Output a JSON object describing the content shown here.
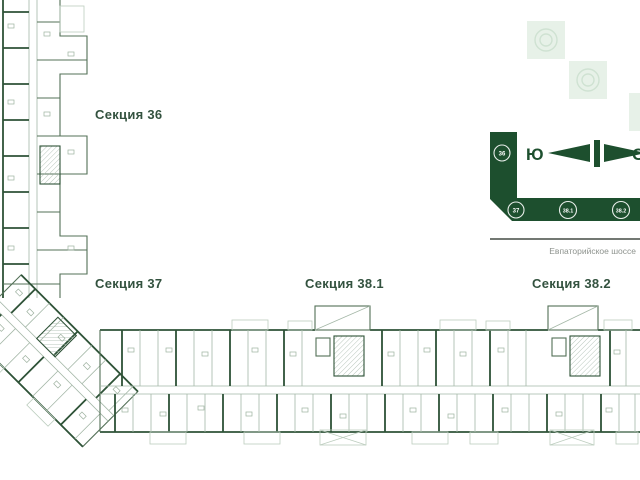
{
  "labels": {
    "section36": "Секция 36",
    "section37": "Секция 37",
    "section381": "Секция 38.1",
    "section382": "Секция 38.2"
  },
  "minimap": {
    "markers": [
      {
        "label": "36"
      },
      {
        "label": "37"
      },
      {
        "label": "38.1"
      },
      {
        "label": "38.2"
      }
    ],
    "compass": {
      "south_label": "Ю",
      "north_label": "С"
    },
    "road_label": "Евпаторийское шоссе"
  },
  "colors": {
    "brand_green": "#1d4f2e",
    "plan_wall": "#2e5237",
    "label_text": "#33523f",
    "muted_square": "#e7f1e8",
    "road_text": "#8e938e"
  }
}
